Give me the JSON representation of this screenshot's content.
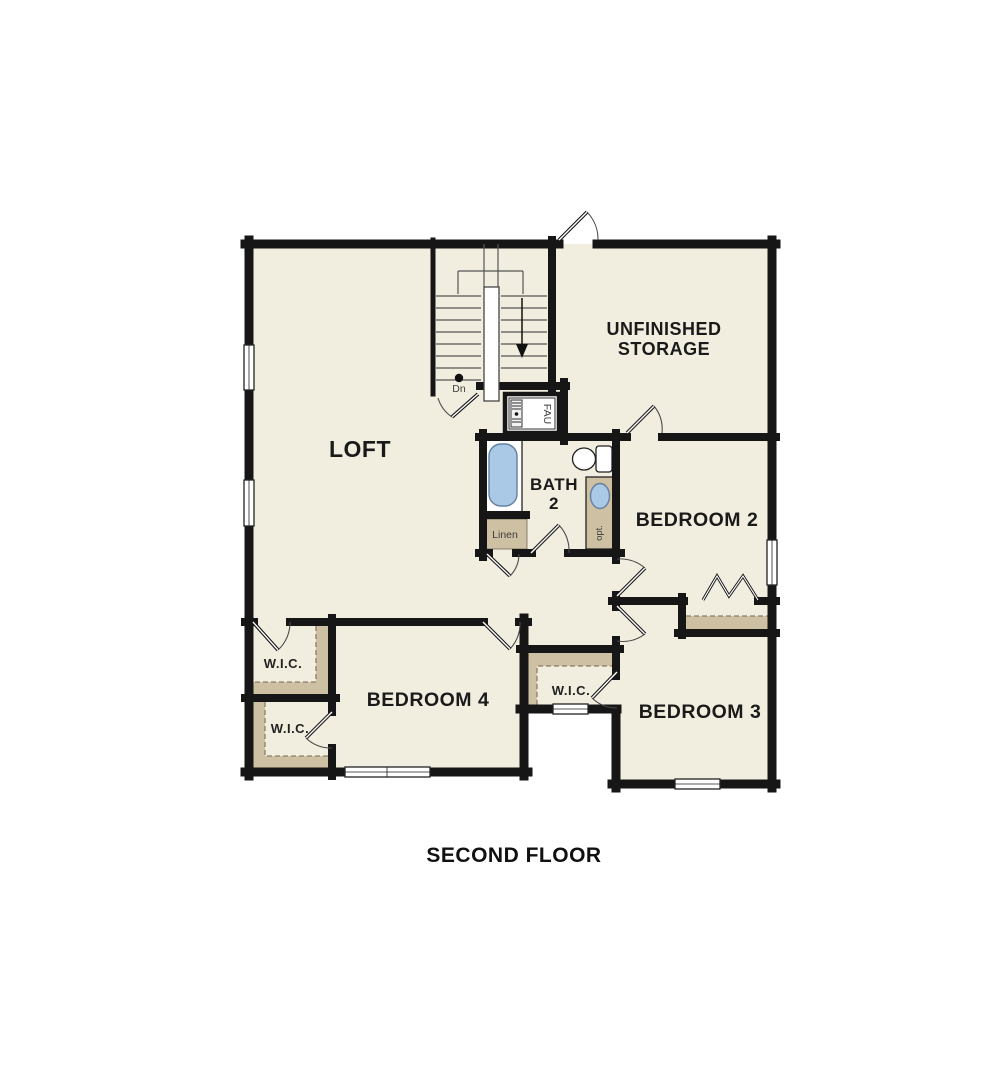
{
  "title": "SECOND FLOOR",
  "colors": {
    "floor": "#f2eedf",
    "wall": "#161616",
    "shelf": "#cec0a2",
    "water": "#a9c9e6",
    "dash": "#8a7e68"
  },
  "labels": {
    "loft": "LOFT",
    "storage1": "UNFINISHED",
    "storage2": "STORAGE",
    "bath1": "BATH",
    "bath2": "2",
    "bedroom2": "BEDROOM 2",
    "bedroom3": "BEDROOM 3",
    "bedroom4": "BEDROOM 4",
    "wic1": "W.I.C.",
    "wic2": "W.I.C.",
    "wic3": "W.I.C.",
    "linen": "Linen",
    "fau": "FAU",
    "dn": "Dn",
    "opt": "opt."
  }
}
